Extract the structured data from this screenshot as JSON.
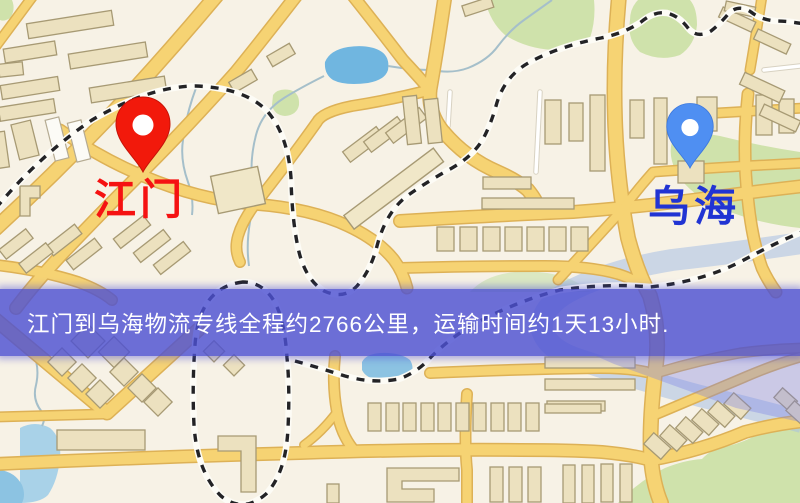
{
  "banner": {
    "text": "江门到乌海物流专线全程约2766公里，运输时间约1天13小时.",
    "background_color": "#4d50d2",
    "text_color": "#ffffff",
    "route": {
      "origin": "江门",
      "destination": "乌海",
      "distance_text": "约2766公里",
      "duration_text": "约1天13小时"
    }
  },
  "markers": {
    "origin": {
      "label": "江门",
      "label_color": "#f51212",
      "pin_color": "#f2190b",
      "pin_icon": "red-map-pin"
    },
    "destination": {
      "label": "乌海",
      "label_color": "#2134d3",
      "pin_color": "#4f8ff2",
      "pin_icon": "blue-map-pin"
    }
  },
  "map": {
    "background_color": "#f7f2e6",
    "road_color": "#f6d373",
    "railway_color": "#232326",
    "water_color": "#70b6e0",
    "park_color": "#cfe2ab",
    "building_color": "#ece1bf"
  }
}
